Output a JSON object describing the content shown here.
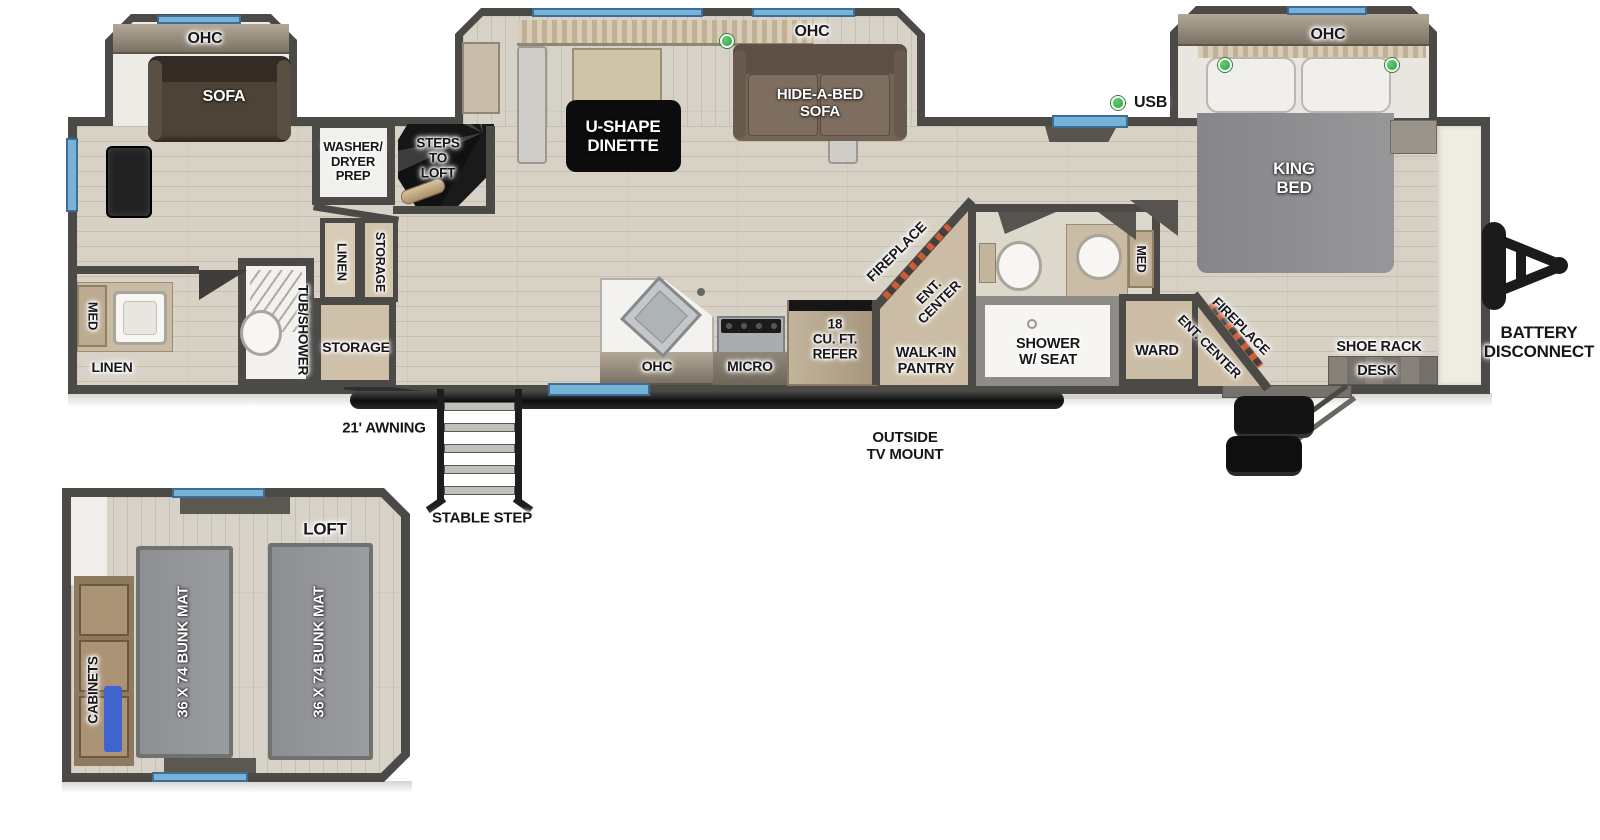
{
  "colors": {
    "wall": "#4b4a47",
    "window_blue": "#79b2d9",
    "usb_green": "#3bb34a",
    "fireplace_red": "#cf5a33"
  },
  "labels": {
    "ohc": "OHC",
    "sofa": "SOFA",
    "usb": "USB",
    "med": "MED",
    "linen": "LINEN",
    "storage": "STORAGE",
    "tub_shower": "TUB/SHOWER",
    "micro": "MICRO",
    "fireplace": "FIREPLACE",
    "ent_center": "ENT. CENTER",
    "ward": "WARD",
    "shoe_rack": "SHOE RACK",
    "desk": "DESK",
    "awning": "21' AWNING",
    "stable_step": "STABLE STEP",
    "loft": "LOFT",
    "cabinets": "CABINETS",
    "bunk_mat": "36 X 74 BUNK MAT",
    "washer_dryer": [
      "WASHER/",
      "DRYER",
      "PREP"
    ],
    "steps_to_loft": [
      "STEPS",
      "TO",
      "LOFT"
    ],
    "u_dinette": [
      "U-SHAPE",
      "DINETTE"
    ],
    "hide_a_bed": [
      "HIDE-A-BED",
      "SOFA"
    ],
    "king_bed": [
      "KING",
      "BED"
    ],
    "refer": [
      "18",
      "CU. FT.",
      "REFER"
    ],
    "ent_center_2l": [
      "ENT.",
      "CENTER"
    ],
    "walk_in_pantry": [
      "WALK-IN",
      "PANTRY"
    ],
    "shower_seat": [
      "SHOWER",
      "W/ SEAT"
    ],
    "battery": [
      "BATTERY",
      "DISCONNECT"
    ],
    "outside_tv": [
      "OUTSIDE",
      "TV MOUNT"
    ]
  }
}
